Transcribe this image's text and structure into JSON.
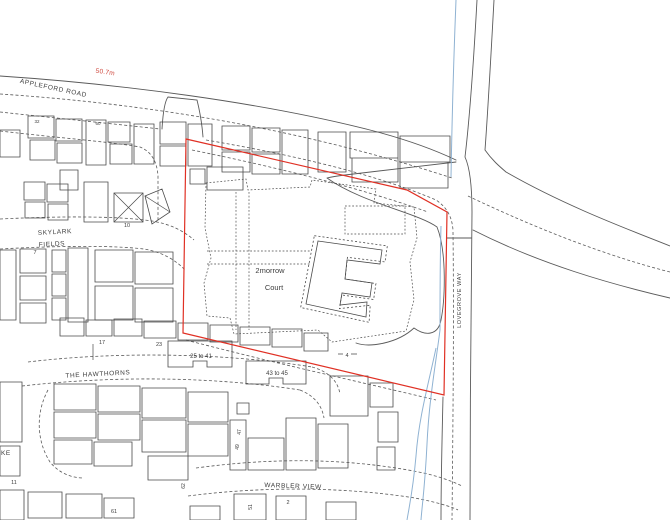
{
  "colors": {
    "line": "#5a5a5a",
    "building": "#4a4a4a",
    "boundary": "#e03024",
    "water": "#8fb2d2",
    "label": "#3d3d3d",
    "measure": "#cf4a40"
  },
  "roads": {
    "appleford": "APPLEFORD ROAD",
    "lovegrove": "LOVEGROVE WAY",
    "skylark_1": "SKYLARK",
    "skylark_2": "FIELDS",
    "hawthorns": "THE HAWTHORNS",
    "warbler": "WARBLER VIEW",
    "partial_left": "KE"
  },
  "site": {
    "name_1": "2morrow",
    "name_2": "Court",
    "measurement": "50.7m"
  },
  "building_labels": {
    "range_a": "25 to 41",
    "range_b": "43 to 45"
  },
  "house_numbers": {
    "n32": "32",
    "n60": "60",
    "n10": "10",
    "n7": "7",
    "n17": "17",
    "n23": "23",
    "n4": "4",
    "n47": "47",
    "n49": "49",
    "n51": "51",
    "n62": "62",
    "n2": "2",
    "n61": "61",
    "n11": "11"
  }
}
